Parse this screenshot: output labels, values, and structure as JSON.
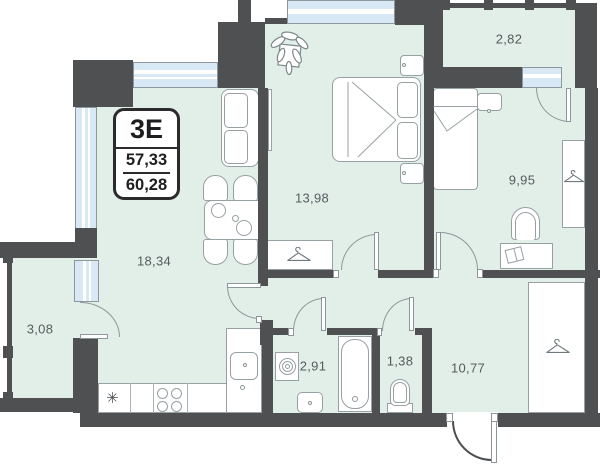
{
  "unit": {
    "label": "3E",
    "area_living": "57,33",
    "area_total": "60,28"
  },
  "rooms": [
    {
      "id": "living-kitchen",
      "area": "18,34"
    },
    {
      "id": "bedroom-main",
      "area": "13,98"
    },
    {
      "id": "bedroom-second",
      "area": "9,95"
    },
    {
      "id": "hallway",
      "area": "10,77"
    },
    {
      "id": "bathroom",
      "area": "2,91"
    },
    {
      "id": "wc",
      "area": "1,38"
    },
    {
      "id": "balcony-top",
      "area": "2,82"
    },
    {
      "id": "balcony-left",
      "area": "3,08"
    }
  ],
  "symbols": {
    "fridge": "✳"
  },
  "colors": {
    "wall": "#4f5052",
    "room_fill": "#e2efe9",
    "window_fill": "#d8e8f5",
    "furniture_outline": "#97a0a3",
    "door_arc": "#8d969a",
    "label_text": "#565b5e",
    "badge_border": "#2b2b2d"
  }
}
